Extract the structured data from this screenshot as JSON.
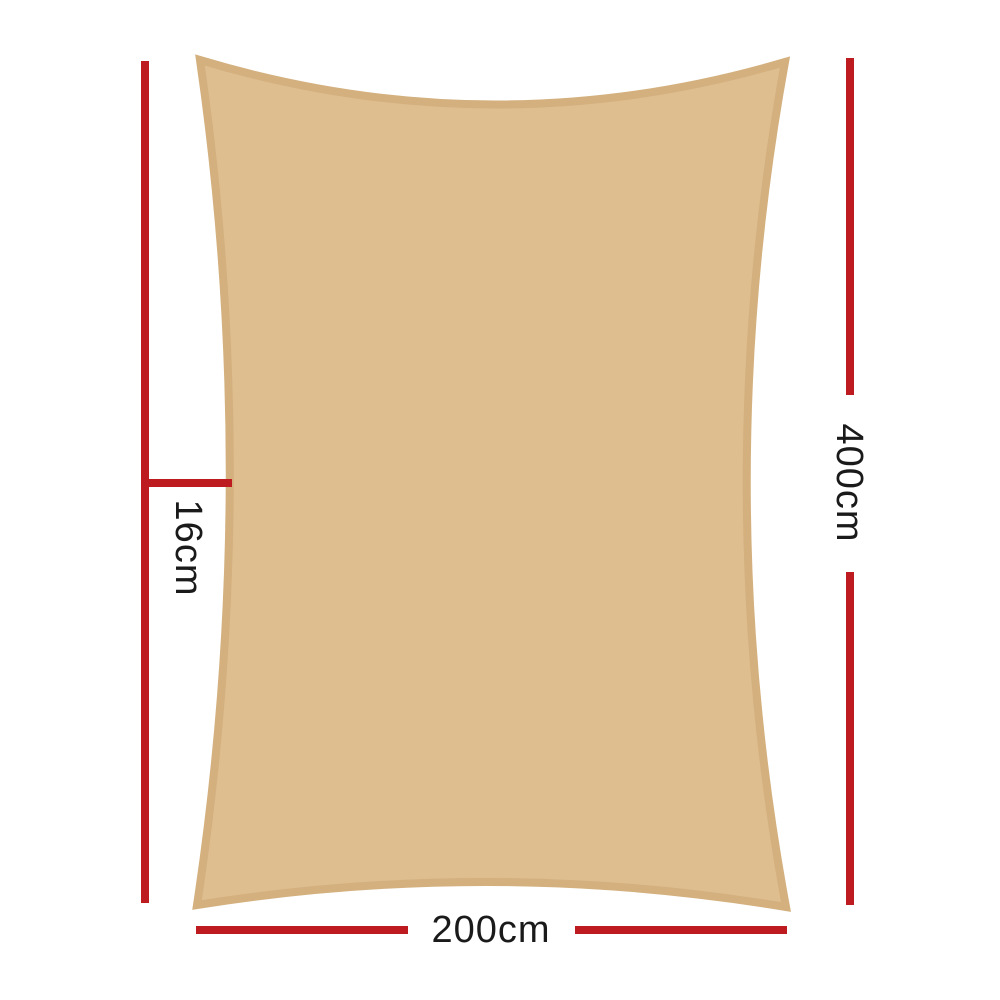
{
  "diagram": {
    "type": "product-dimension-diagram",
    "subject": "rectangle shade sail with concave edges",
    "background_color": "#ffffff",
    "sail": {
      "fill": "#DEBD8F",
      "border": "#D3B07E"
    },
    "dimensions": {
      "line_color": "#BD1B20",
      "text_color": "#1A1A1A",
      "height_label": "400cm",
      "width_label": "200cm",
      "pocket_label": "16cm"
    }
  }
}
